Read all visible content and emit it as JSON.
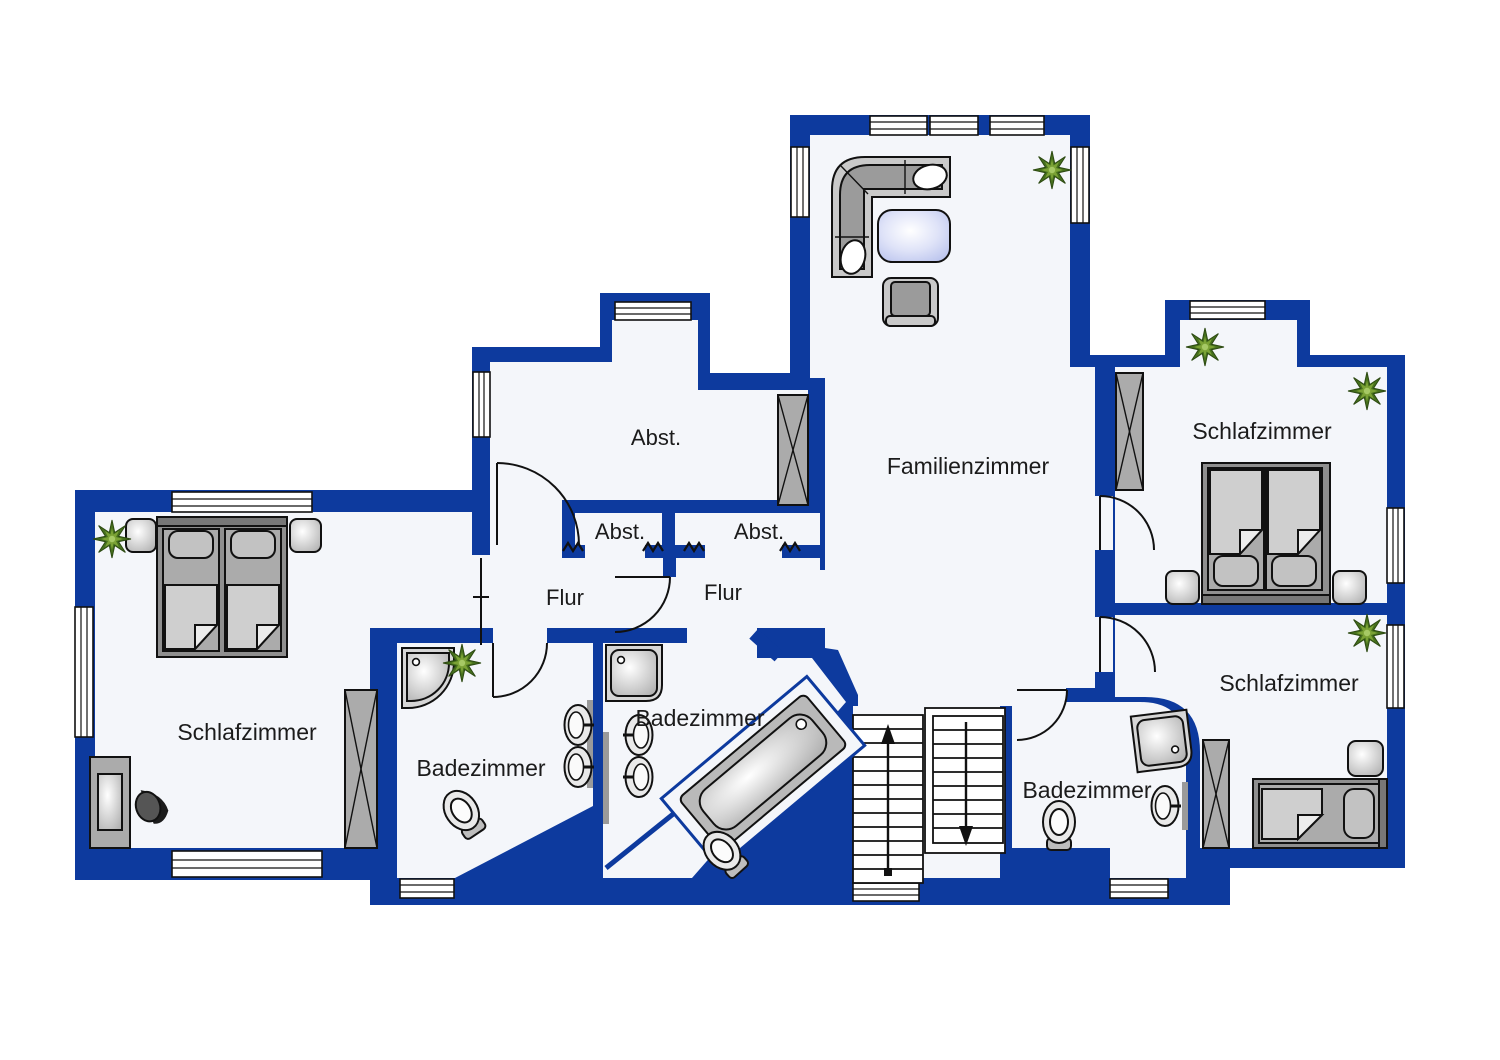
{
  "plan": {
    "type": "floor-plan",
    "language": "de",
    "wall_color": "#0d3a9e",
    "floor_color": "#f4f6fa",
    "background_color": "#ffffff",
    "rooms": {
      "familienzimmer": "Familienzimmer",
      "schlafzimmer_top_right": "Schlafzimmer",
      "schlafzimmer_left": "Schlafzimmer",
      "schlafzimmer_bottom_right": "Schlafzimmer",
      "badezimmer_left": "Badezimmer",
      "badezimmer_center": "Badezimmer",
      "badezimmer_right": "Badezimmer",
      "abstellraum_large": "Abst.",
      "abstellraum_small_left": "Abst.",
      "abstellraum_small_right": "Abst.",
      "flur_left": "Flur",
      "flur_right": "Flur"
    },
    "furniture_symbols": [
      "corner-sofa",
      "coffee-table",
      "armchair",
      "double-bed",
      "single-bed",
      "nightstand",
      "wardrobe",
      "desk",
      "desk-chair",
      "corner-shower",
      "shower",
      "bathtub",
      "toilet",
      "washbasin",
      "staircase",
      "plant",
      "window",
      "door"
    ],
    "staircase": {
      "up_arrow": true,
      "down_arrow": true
    }
  }
}
